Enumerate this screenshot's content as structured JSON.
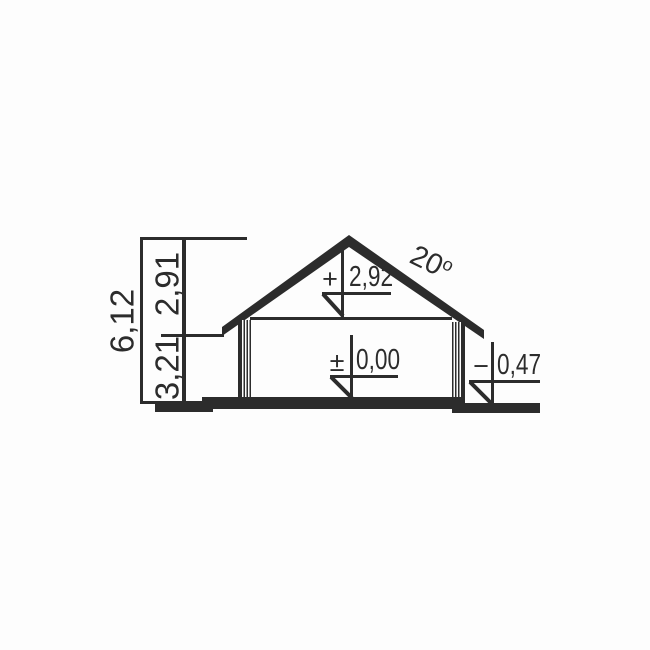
{
  "drawing": {
    "ink_color": "#2c2c2c",
    "background_color": "#fdfdfd",
    "dimension_chain": {
      "total": "6,12",
      "upper": "2,91",
      "lower": "3,21"
    },
    "levels": {
      "attic_floor": {
        "sign": "+",
        "value": "2,92"
      },
      "ground_floor": {
        "sign": "±",
        "value": "0,00"
      },
      "exterior_grade": {
        "sign": "−",
        "value": "0,47"
      }
    },
    "roof": {
      "angle": "20",
      "degree_mark": "o"
    }
  }
}
